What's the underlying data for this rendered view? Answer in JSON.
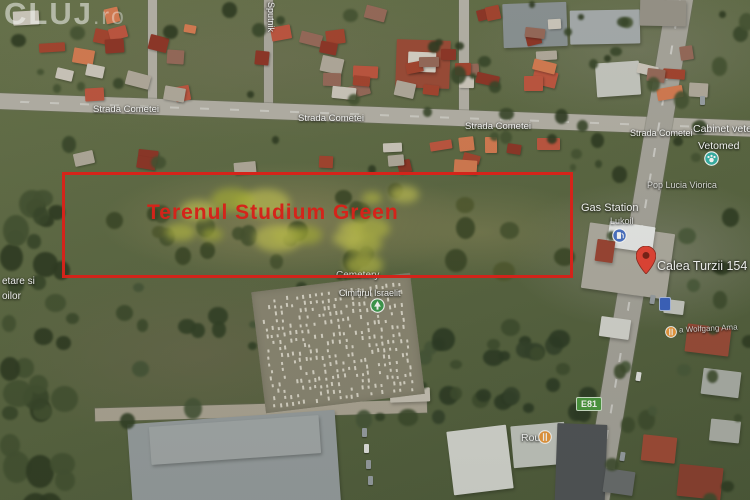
{
  "watermark": {
    "name": "CLUJ",
    "suffix": ".ro"
  },
  "parcel": {
    "label": "Terenul Studium Green"
  },
  "streets": {
    "cometei": "Strada Cometei",
    "sputnik": "Sputnik"
  },
  "places": {
    "cabinet_vet": "Cabinet vete",
    "vetomed": "Vetomed",
    "pop_lucia": "Pop Lucia Viorica",
    "gas_station": "Gas Station",
    "lukoil": "Lukoil",
    "address_pin": "Calea Turzii 154",
    "cemetery_en": "Cemetery",
    "cemetery_ro": "Cimitirul Israelit",
    "left_edge_line1": "etare si",
    "left_edge_line2": "oilor",
    "wolfgang": "a Wolfgang Ama",
    "rou": "Rou"
  },
  "roads": {
    "e81": "E81"
  },
  "icons": {
    "address_pin": "red-map-pin",
    "vet_clinic": "teal-place-dot",
    "park_tree": "green-tree-marker",
    "fuel": "blue-fuel-dot",
    "food": "orange-food-dot",
    "road_shield": "blue-road-shield"
  },
  "colors": {
    "parcel_outline": "#e32119",
    "parcel_text": "#e32119",
    "pin_red": "#e94335",
    "vet_teal": "#36b3a8",
    "park_green": "#3d9b4f",
    "fuel_blue": "#4a73c9",
    "food_orange": "#ef9a3d",
    "shield_green": "#4c9a3f"
  }
}
